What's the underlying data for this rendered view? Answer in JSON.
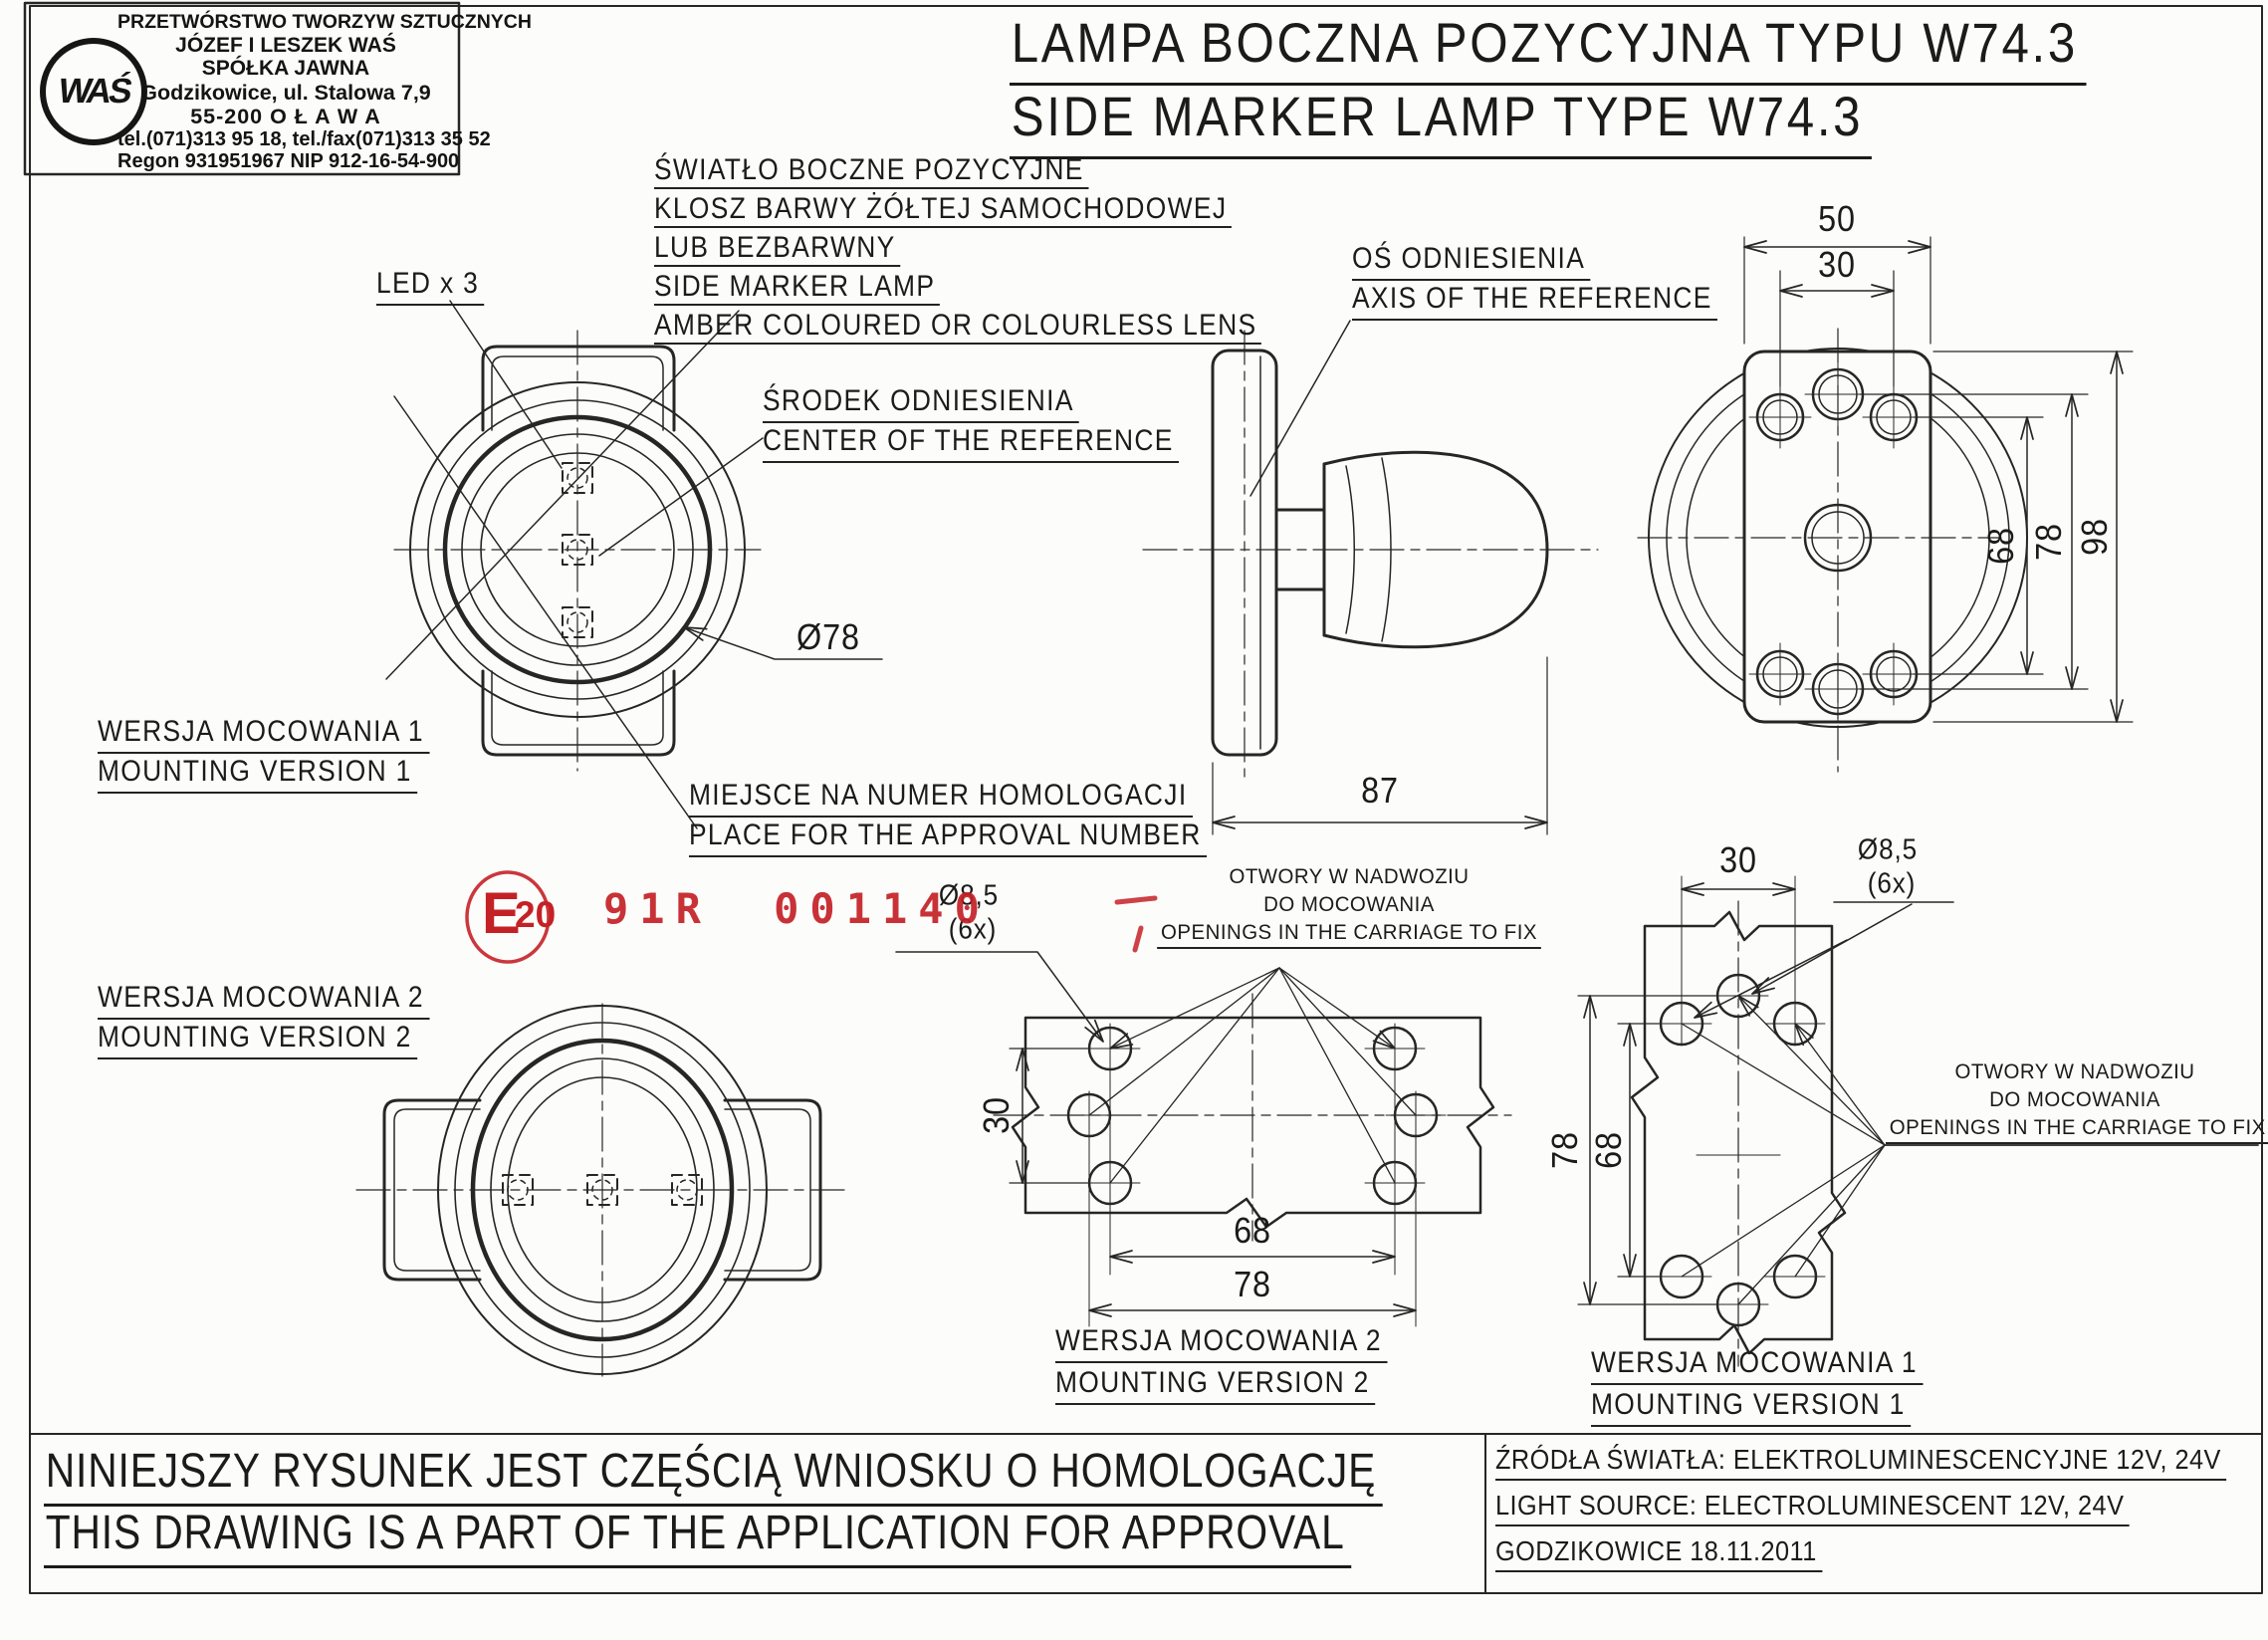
{
  "company": {
    "logo_text": "WAŚ",
    "name_line1": "PRZETWÓRSTWO TWORZYW SZTUCZNYCH",
    "name_line2": "JÓZEF I LESZEK WAŚ",
    "name_line3": "SPÓŁKA JAWNA",
    "address_line1": "Godzikowice, ul. Stalowa 7,9",
    "address_line2": "55-200  O Ł A W A",
    "phone": "tel.(071)313 95 18, tel./fax(071)313 35 52",
    "ids": "Regon 931951967 NIP 912-16-54-900"
  },
  "title": {
    "pl": "LAMPA BOCZNA POZYCYJNA TYPU W74.3",
    "en": "SIDE MARKER LAMP TYPE W74.3"
  },
  "annotations": {
    "lens_note": {
      "pl1": "ŚWIATŁO BOCZNE POZYCYJNE",
      "pl2": "KLOSZ BARWY ŻÓŁTEJ SAMOCHODOWEJ",
      "pl3": "LUB BEZBARWNY",
      "en1": "SIDE MARKER LAMP",
      "en2": "AMBER COLOURED OR COLOURLESS LENS"
    },
    "led": "LED x 3",
    "axis": {
      "pl": "OŚ ODNIESIENIA",
      "en": "AXIS OF THE REFERENCE"
    },
    "center": {
      "pl": "ŚRODEK ODNIESIENIA",
      "en": "CENTER OF THE REFERENCE"
    },
    "approval_place": {
      "pl": "MIEJSCE NA NUMER HOMOLOGACJI",
      "en": "PLACE FOR THE APPROVAL NUMBER"
    },
    "mounting_v1": {
      "pl": "WERSJA MOCOWANIA 1",
      "en": "MOUNTING VERSION 1"
    },
    "mounting_v2": {
      "pl": "WERSJA MOCOWANIA 2",
      "en": "MOUNTING VERSION 2"
    },
    "openings": {
      "pl1": "OTWORY W NADWOZIU",
      "pl2": "DO MOCOWANIA",
      "en": "OPENINGS IN THE CARRIAGE TO FIX"
    }
  },
  "stamp": {
    "e_mark": "E",
    "e_number": "20",
    "approval_code": "91R 001140",
    "color": "#c42127"
  },
  "dimensions": {
    "back_view": {
      "plate_width": "50",
      "hole_spacing_h": "30",
      "hole_spacing_v_inner": "68",
      "hole_spacing_v_outer": "78",
      "plate_height": "98"
    },
    "side_view": {
      "depth": "87"
    },
    "front_view": {
      "lens_diameter": "Ø78"
    },
    "holes_v2": {
      "hole_dia": "Ø8,5",
      "hole_count": "(6x)",
      "row_spacing": "30",
      "col_spacing_inner": "68",
      "col_spacing_outer": "78"
    },
    "holes_v1": {
      "hole_dia": "Ø8,5",
      "hole_count": "(6x)",
      "col_spacing": "30",
      "row_spacing_outer": "78",
      "row_spacing_inner": "68"
    }
  },
  "footer": {
    "statement_pl": "NINIEJSZY RYSUNEK JEST CZĘŚCIĄ WNIOSKU O  HOMOLOGACJĘ",
    "statement_en": "THIS DRAWING IS A PART OF THE APPLICATION FOR  APPROVAL",
    "light_source_pl": "ŹRÓDŁA ŚWIATŁA: ELEKTROLUMINESCENCYJNE  12V, 24V",
    "light_source_en": "LIGHT SOURCE: ELECTROLUMINESCENT  12V, 24V",
    "place_date": "GODZIKOWICE 18.11.2011"
  }
}
